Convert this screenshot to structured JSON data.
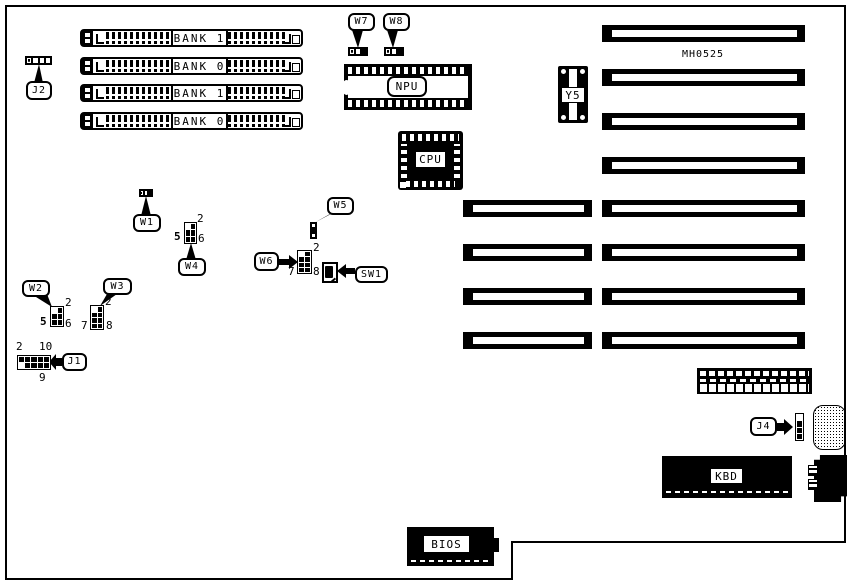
{
  "diagram": {
    "board_id": "MH0525"
  },
  "memory_banks": [
    {
      "label": "BANK 1"
    },
    {
      "label": "BANK 0"
    },
    {
      "label": "BANK 1"
    },
    {
      "label": "BANK 0"
    }
  ],
  "chips": {
    "npu": "NPU",
    "cpu": "CPU",
    "crystal": "Y5",
    "keyboard": "KBD",
    "bios": "BIOS"
  },
  "callouts": {
    "j1": "J1",
    "j2": "J2",
    "j4": "J4",
    "w1": "W1",
    "w2": "W2",
    "w3": "W3",
    "w4": "W4",
    "w5": "W5",
    "w6": "W6",
    "w7": "W7",
    "w8": "W8",
    "sw1": "SW1"
  },
  "pin_labels": {
    "w2": {
      "top_right": "2",
      "bottom_left": "5",
      "bottom_right": "6"
    },
    "w3": {
      "top_right": "2",
      "bottom_left": "7",
      "bottom_right": "8"
    },
    "w4": {
      "top_right": "2",
      "bottom_left": "5",
      "bottom_right": "6"
    },
    "w6": {
      "top_right": "2",
      "bottom_left": "7",
      "bottom_right": "8"
    },
    "j1": {
      "top_left": "2",
      "top_right": "10",
      "bottom_right": "9"
    }
  },
  "colors": {
    "line": "#000000",
    "background": "#ffffff"
  }
}
